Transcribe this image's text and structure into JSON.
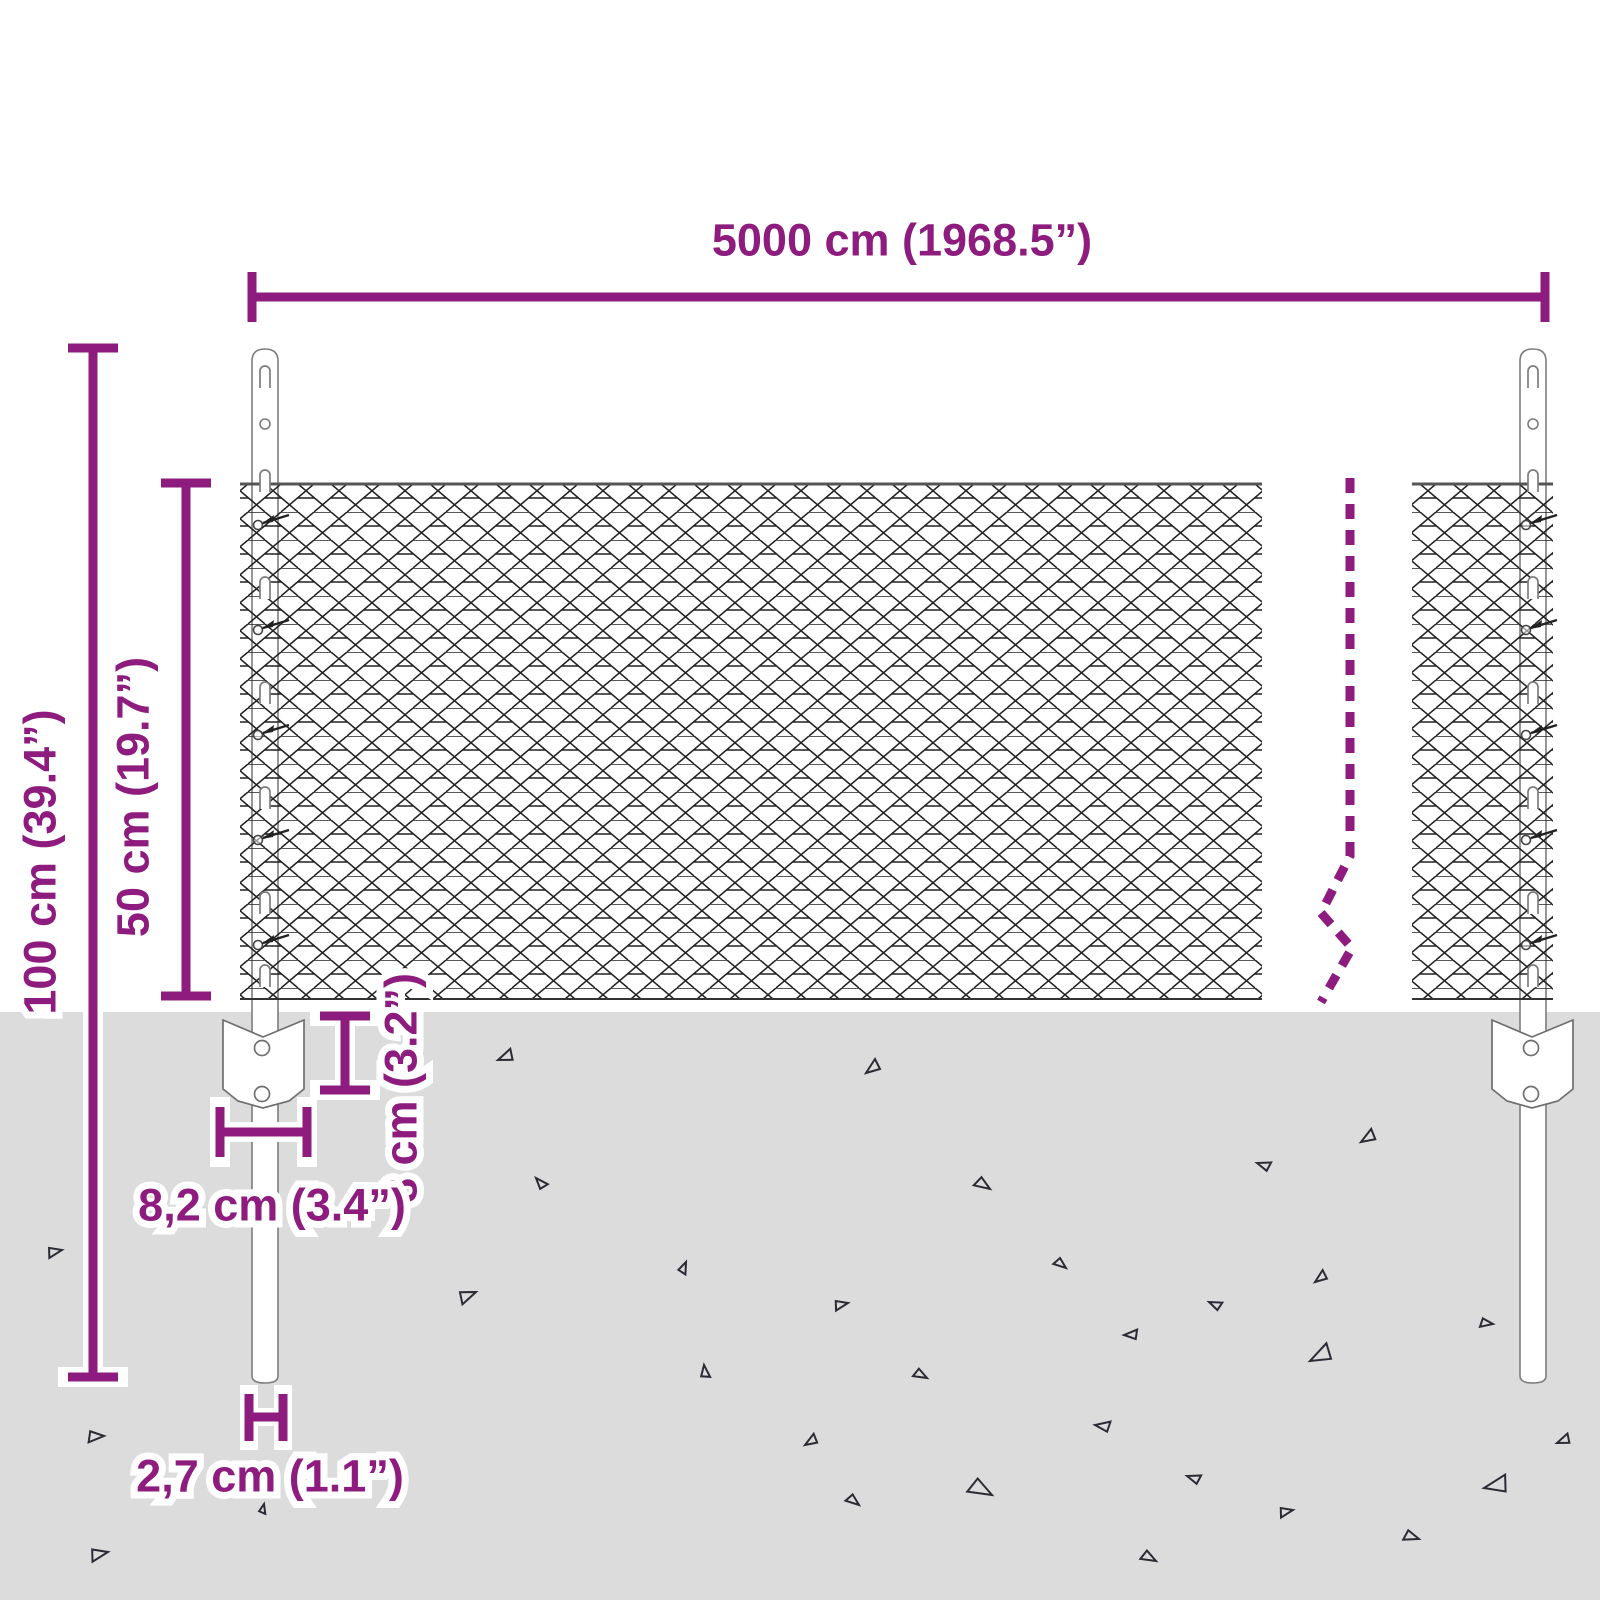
{
  "labels": {
    "total_width": "5000 cm (1968.5”)",
    "total_height": "100 cm (39.4”)",
    "mesh_height": "50 cm (19.7”)",
    "anchor_depth": "8 cm (3.2”)",
    "anchor_width": "8,2 cm (3.4”)",
    "post_width": "2,7 cm (1.1”)"
  },
  "colors": {
    "dimension": "#8e1c7e",
    "ground": "#dcdcdc",
    "mesh_line": "#222222",
    "post_outline": "#7d7d7d"
  }
}
